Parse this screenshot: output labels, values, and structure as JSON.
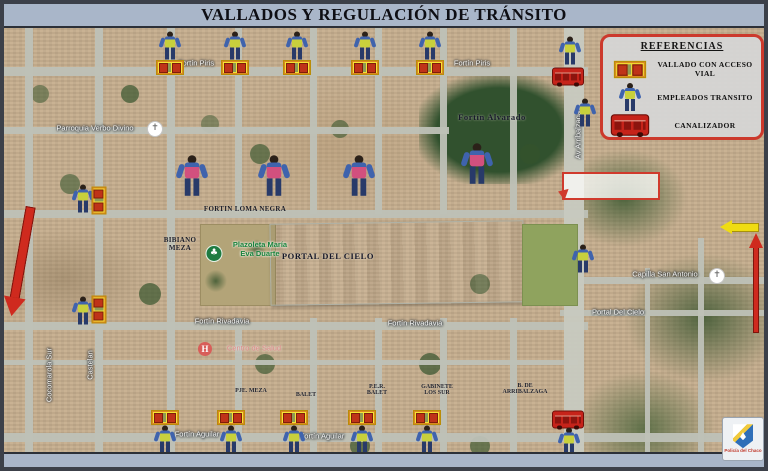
{
  "title": "VALLADOS Y REGULACIÓN DE TRÁNSITO",
  "legend": {
    "title": "REFERENCIAS",
    "items": [
      {
        "icon": "barrier-icon",
        "label": "VALLADO CON ACCESO VIAL"
      },
      {
        "icon": "transit-employee-icon",
        "label": "EMPLEADOS TRANSITO"
      },
      {
        "icon": "channelizer-icon",
        "label": "CANALIZADOR"
      }
    ]
  },
  "icons": {
    "church-icon": "✝",
    "park-icon": "♣",
    "hospital-icon": "H"
  },
  "map": {
    "labels": [
      {
        "text": "Fortín Piris",
        "x": 192,
        "y": 35,
        "style": "street"
      },
      {
        "text": "Fortín Piris",
        "x": 468,
        "y": 35,
        "style": "street"
      },
      {
        "text": "Fortín Alvarado",
        "x": 488,
        "y": 89,
        "style": "dark-lg"
      },
      {
        "text": "Parroquia Verbo Divino",
        "x": 91,
        "y": 100,
        "style": "street"
      },
      {
        "text": "FORTIN LOMA NEGRA",
        "x": 241,
        "y": 181,
        "style": "dark"
      },
      {
        "lines": [
          "BIBIANO",
          "MEZA"
        ],
        "x": 176,
        "y": 216,
        "style": "dark"
      },
      {
        "lines": [
          "Plazoleta María",
          "Eva Duarte"
        ],
        "x": 256,
        "y": 221,
        "style": "green"
      },
      {
        "text": "PORTAL DEL CIELO",
        "x": 324,
        "y": 228,
        "style": "dark-lg"
      },
      {
        "text": "Fortín Rivadavia",
        "x": 218,
        "y": 293,
        "style": "street"
      },
      {
        "text": "Fortín Rivadavia",
        "x": 411,
        "y": 295,
        "style": "street"
      },
      {
        "text": "Centro de Salud",
        "x": 250,
        "y": 320,
        "style": "health"
      },
      {
        "text": "Capilla San Antonio",
        "x": 661,
        "y": 246,
        "style": "street"
      },
      {
        "text": "Portal Del Cielo",
        "x": 614,
        "y": 284,
        "style": "street"
      },
      {
        "text": "PJE. MEZA",
        "x": 247,
        "y": 363,
        "style": "dark-sm"
      },
      {
        "text": "BALET",
        "x": 302,
        "y": 367,
        "style": "dark-sm"
      },
      {
        "lines": [
          "P.E.R.",
          "BALET"
        ],
        "x": 373,
        "y": 362,
        "style": "dark-sm"
      },
      {
        "lines": [
          "GABINETE",
          "LOS SUR"
        ],
        "x": 433,
        "y": 362,
        "style": "dark-sm"
      },
      {
        "lines": [
          "B. DE",
          "ARRIBALZAGA"
        ],
        "x": 521,
        "y": 361,
        "style": "dark-sm"
      },
      {
        "text": "Fortín Aguilar",
        "x": 193,
        "y": 406,
        "style": "street"
      },
      {
        "text": "Fortín Aguilar",
        "x": 318,
        "y": 408,
        "style": "street"
      },
      {
        "text": "Cocomarola Sur",
        "x": 45,
        "y": 347,
        "style": "street-v"
      },
      {
        "text": "Castelan",
        "x": 86,
        "y": 337,
        "style": "street-v"
      },
      {
        "text": "Av Arribalzaga",
        "x": 574,
        "y": 107,
        "style": "street-v"
      }
    ],
    "markers": [
      {
        "type": "employee",
        "x": 166,
        "y": 20
      },
      {
        "type": "employee",
        "x": 231,
        "y": 20
      },
      {
        "type": "employee",
        "x": 293,
        "y": 20
      },
      {
        "type": "employee",
        "x": 361,
        "y": 20
      },
      {
        "type": "employee",
        "x": 426,
        "y": 20
      },
      {
        "type": "barrier",
        "x": 166,
        "y": 42
      },
      {
        "type": "barrier",
        "x": 231,
        "y": 42
      },
      {
        "type": "barrier",
        "x": 293,
        "y": 42
      },
      {
        "type": "barrier",
        "x": 361,
        "y": 42
      },
      {
        "type": "barrier",
        "x": 426,
        "y": 42
      },
      {
        "type": "employee",
        "x": 566,
        "y": 25
      },
      {
        "type": "channelizer",
        "x": 564,
        "y": 51
      },
      {
        "type": "employee",
        "x": 581,
        "y": 87
      },
      {
        "type": "employee",
        "x": 79,
        "y": 173
      },
      {
        "type": "barrier-v",
        "x": 95,
        "y": 175
      },
      {
        "type": "employee",
        "x": 79,
        "y": 285
      },
      {
        "type": "barrier-v",
        "x": 95,
        "y": 284
      },
      {
        "type": "employee-lg",
        "x": 188,
        "y": 150
      },
      {
        "type": "employee-lg",
        "x": 270,
        "y": 150
      },
      {
        "type": "employee-lg",
        "x": 355,
        "y": 150
      },
      {
        "type": "employee-lg",
        "x": 473,
        "y": 138
      },
      {
        "type": "employee",
        "x": 579,
        "y": 233
      },
      {
        "type": "barrier",
        "x": 161,
        "y": 392
      },
      {
        "type": "barrier",
        "x": 227,
        "y": 392
      },
      {
        "type": "barrier",
        "x": 290,
        "y": 392
      },
      {
        "type": "barrier",
        "x": 358,
        "y": 392
      },
      {
        "type": "barrier",
        "x": 423,
        "y": 392
      },
      {
        "type": "employee",
        "x": 161,
        "y": 414
      },
      {
        "type": "employee",
        "x": 227,
        "y": 414
      },
      {
        "type": "employee",
        "x": 290,
        "y": 414
      },
      {
        "type": "employee",
        "x": 358,
        "y": 414
      },
      {
        "type": "employee",
        "x": 423,
        "y": 414
      },
      {
        "type": "channelizer",
        "x": 564,
        "y": 394
      },
      {
        "type": "employee",
        "x": 565,
        "y": 416
      },
      {
        "type": "church",
        "x": 151,
        "y": 99
      },
      {
        "type": "church",
        "x": 713,
        "y": 246
      },
      {
        "type": "park",
        "x": 210,
        "y": 224
      },
      {
        "type": "hospital",
        "x": 201,
        "y": 320
      }
    ]
  },
  "footer": {
    "police_label": "Policía del Chaco"
  }
}
